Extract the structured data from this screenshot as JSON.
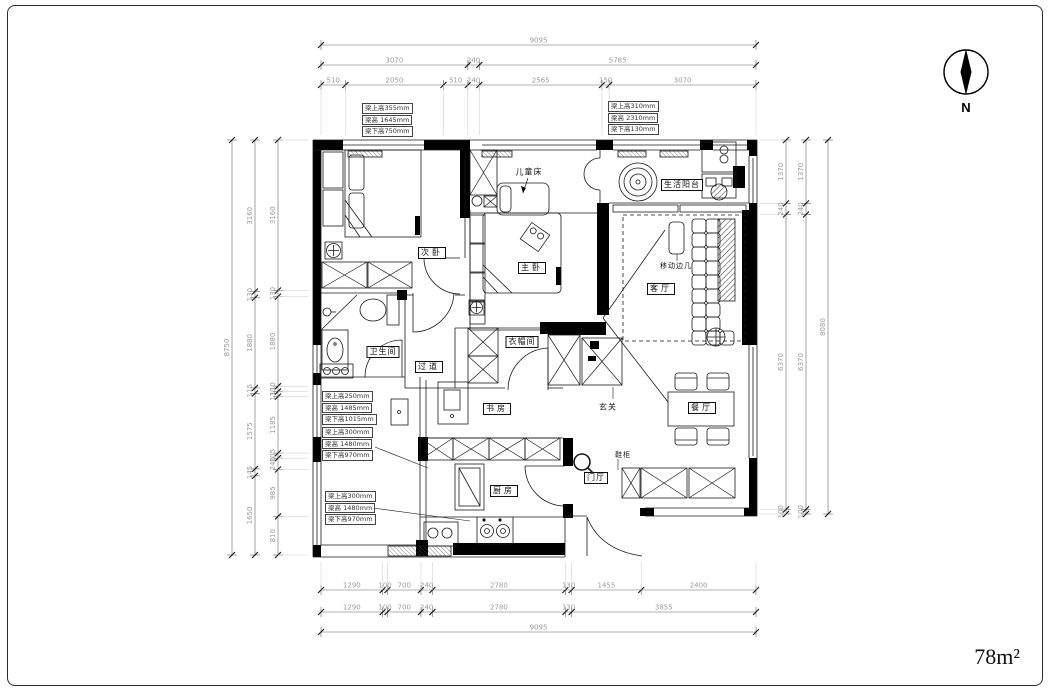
{
  "meta": {
    "area_label": "78m²",
    "north_label": "N"
  },
  "dims": {
    "top": {
      "total": [
        "9095"
      ],
      "row2": [
        "3070",
        "240",
        "5785"
      ],
      "row3": [
        "510",
        "2050",
        "510",
        "240",
        "2565",
        "150",
        "3070"
      ]
    },
    "bottom": {
      "row1": [
        "1290",
        "100",
        "700",
        "240",
        "2780",
        "130",
        "1455",
        "2400"
      ],
      "row2": [
        "1290",
        "100",
        "700",
        "240",
        "2780",
        "130",
        "3855"
      ],
      "total": [
        "9095"
      ]
    },
    "left": {
      "outer_total": [
        "8750"
      ],
      "mid": [
        "3160",
        "130",
        "1880",
        "115",
        "1575",
        "145",
        "1650"
      ],
      "inner": [
        "3160",
        "130",
        "1880",
        "110",
        "110",
        "1185",
        "105",
        "240",
        "985",
        "810"
      ]
    },
    "right": {
      "inner": [
        "1370",
        "240",
        "6370",
        "100"
      ],
      "mid": [
        "1370",
        "240",
        "6370",
        "100"
      ],
      "outer_total": [
        "8080"
      ]
    }
  },
  "beam_notes": {
    "top_left": [
      "梁上高355mm",
      "梁高 1645mm",
      "梁下高750mm"
    ],
    "top_right": [
      "梁上高310mm",
      "梁高 2310mm",
      "梁下高130mm"
    ],
    "mid_left_upper": [
      "梁上高250mm",
      "梁高 1485mm",
      "梁下高1015mm"
    ],
    "mid_left_lower": [
      "梁上高300mm",
      "梁高 1480mm",
      "梁下高970mm"
    ],
    "bottom_left": [
      "梁上高300mm",
      "梁高 1480mm",
      "梁下高970mm"
    ]
  },
  "rooms": {
    "second_bedroom": "次卧",
    "children_bed": "儿童床",
    "master_bedroom": "主卧",
    "living_balcony": "生活阳台",
    "living_room": "客厅",
    "movable_side_table": "移动边几",
    "bathroom": "卫生间",
    "hallway": "过道",
    "cloakroom": "衣帽间",
    "study": "书房",
    "foyer": "玄关",
    "dining_room": "餐厅",
    "shoe_cabinet": "鞋柜",
    "entry_hall": "门厅",
    "kitchen": "厨房"
  },
  "colors": {
    "line": "#1a1a1a",
    "dim_text": "#9b9b9b",
    "wall_fill": "#000000"
  }
}
